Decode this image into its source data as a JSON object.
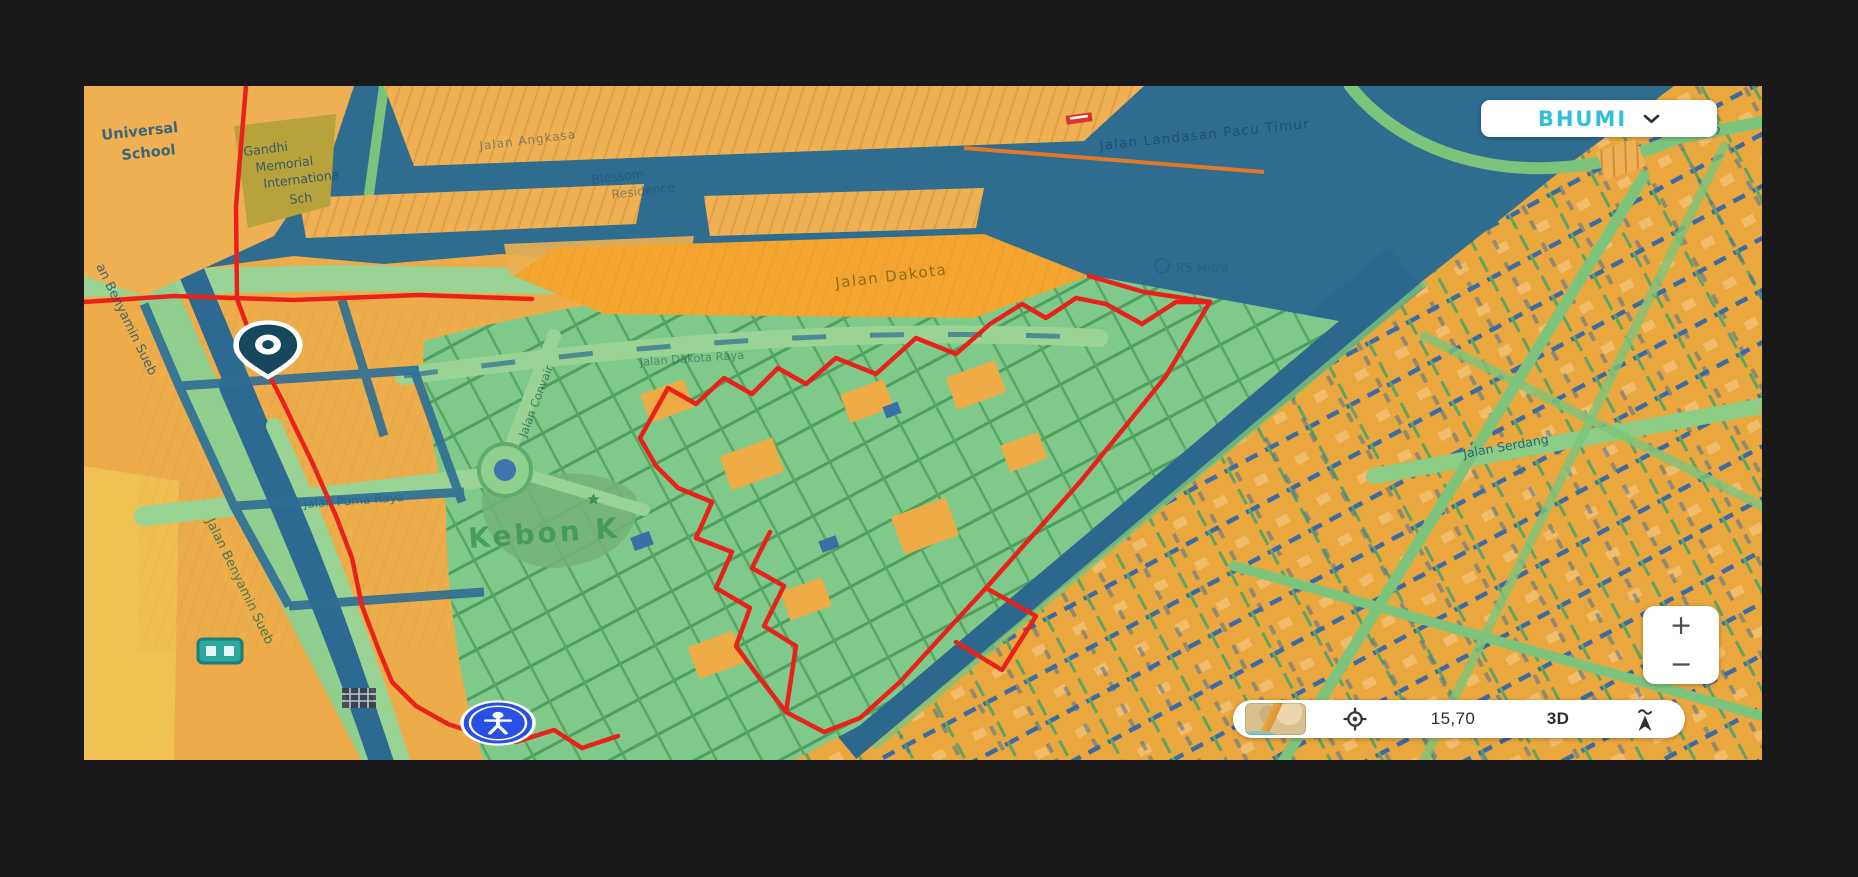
{
  "app": {
    "background_color": "#191919"
  },
  "style_switcher": {
    "label": "BHUMI",
    "logo_color": "#2fc1da",
    "chevron_icon": "chevron-down"
  },
  "zoom_control": {
    "zoom_in_label": "+",
    "zoom_out_label": "−"
  },
  "status_bar": {
    "basemap_thumbnail_icon": "mini-map-preview",
    "locate_icon": "crosshair-target",
    "zoom_value": "15,70",
    "mode_3d_label": "3D",
    "compass_icon": "north-arrow"
  },
  "markers": [
    {
      "name": "location-pin",
      "shape": "teardrop-with-ring",
      "color": "#17475f"
    },
    {
      "name": "pedestrian-marker",
      "shape": "circle-person",
      "color": "#2a4fe4"
    }
  ],
  "map_labels": {
    "universal_school_line1": "Universal",
    "universal_school_line2": "School",
    "gandhi_line1": "Gandhi",
    "gandhi_line2": "Memorial",
    "gandhi_line3": "Internationa",
    "gandhi_line4": "Sch",
    "jalan_angkasa": "Jalan Angkasa",
    "blossom_line1": "Blossom",
    "blossom_line2": "Residence",
    "jalan_landasan_pacu_timur": "Jalan Landasan Pacu Timur",
    "jalan_top_right": "Jalan",
    "rs_mitra": "RS Mitra",
    "jalan_dakota": "Jalan Dakota",
    "jalan_dakota_raya": "Jalan Dakota Raya",
    "kebon": "Kebon K",
    "jalan_puma_raya": "Jalan Puma Raya",
    "jalan_convair": "Jalan Convair",
    "jalan_benyamin_sueb_upper": "an Benyamin Sueb",
    "jalan_benyamin_sueb_lower": "Jalan Benyamin Sueb",
    "jalan_serdang": "Jalan Serdang"
  },
  "map_colors": {
    "urban_orange": "#eaa73e",
    "water_blue": "#2f6d90",
    "green_area": "#7fc98a",
    "road_green": "#9ad494",
    "boundary_red": "#e8221b"
  }
}
